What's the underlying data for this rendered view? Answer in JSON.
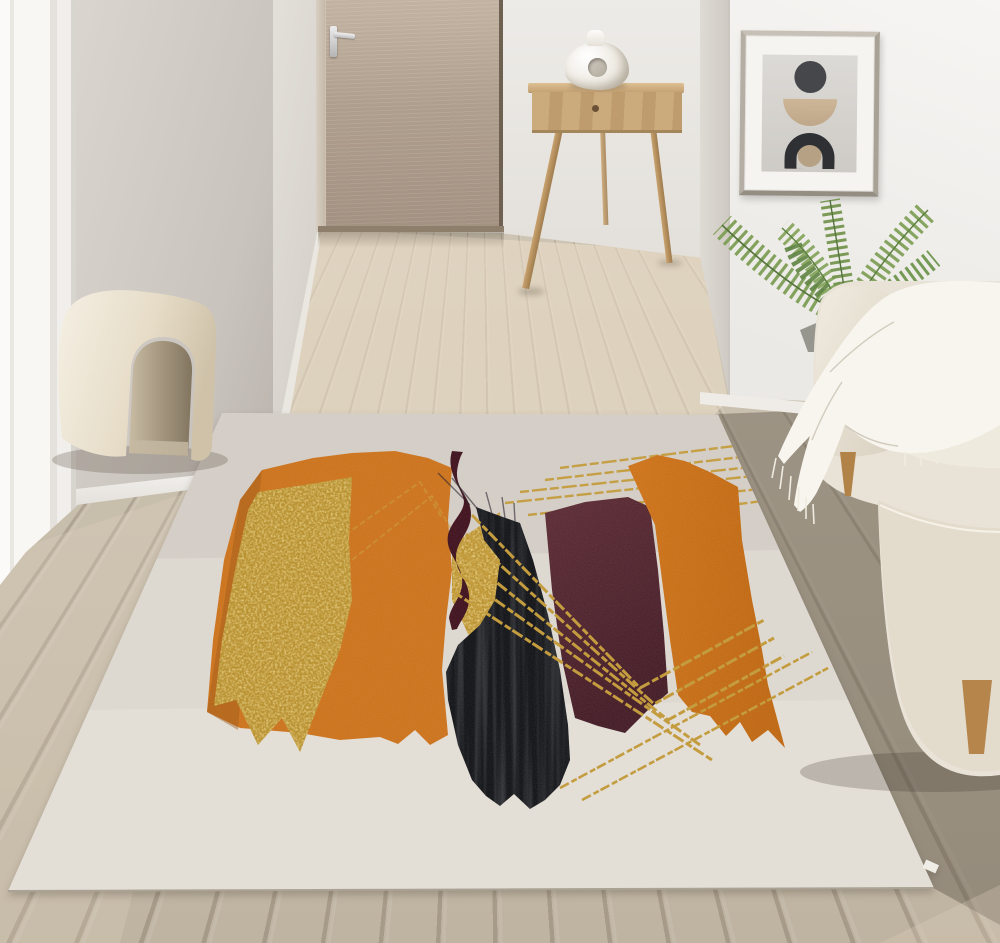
{
  "scene": {
    "type": "interior-photo",
    "description": "Bright modern living room with light diagonal wood-plank flooring, a hallway with a wooden door, a console table with a white donut vase, framed abstract wall art, an areca palm, a cream sofa with a white fringed throw blanket, an arched cream boucle ottoman, and a large abstract area rug",
    "objects": [
      {
        "name": "area-rug",
        "style": "modern abstract",
        "shapes": [
          "gold foil block",
          "large orange block",
          "dark maroon wavy ribbon",
          "black brushstroke column",
          "burgundy block",
          "right orange block with arrow point",
          "gold stitched accent lines"
        ]
      },
      {
        "name": "wooden-door",
        "state": "closed",
        "hardware": "chrome lever handle"
      },
      {
        "name": "console-table",
        "material": "light oak",
        "details": "single drawer with round knob, splayed legs"
      },
      {
        "name": "ceramic-vase",
        "style": "white donut vase with center hole"
      },
      {
        "name": "framed-art",
        "motifs": [
          "dark circle",
          "tan semicircle bowl",
          "black arch over tan dot"
        ],
        "frame": "champagne metal with white mat"
      },
      {
        "name": "palm-plant",
        "species": "areca palm fronds"
      },
      {
        "name": "sofa",
        "color": "cream",
        "accessory": "white fringed throw blanket",
        "legs": "tapered wood"
      },
      {
        "name": "ottoman",
        "style": "cream arch / tunnel shape"
      },
      {
        "name": "floor",
        "material": "light oak planks laid toward vanishing point, darker gray planks at right"
      }
    ]
  },
  "colors": {
    "accent_orange": "#cd7520",
    "accent_orange_deep": "#c06a16",
    "rug_gold": "#b8902f",
    "gold_line": "#c39b3c",
    "rug_black": "#17181c",
    "rug_maroon": "#532731",
    "rug_ribbon": "#431622",
    "rug_cream": "#ddd8d0",
    "wall_white": "#f4f3f1",
    "wall_left": "#cfc9c3",
    "door_wood": "#b2a291",
    "table_wood": "#c9a878",
    "floor_light": "#c9beab",
    "floor_dark": "#8f867a",
    "sofa_cream": "#e9e3d7",
    "blanket_white": "#f8f5ee",
    "plant_green": "#7a9b52"
  }
}
